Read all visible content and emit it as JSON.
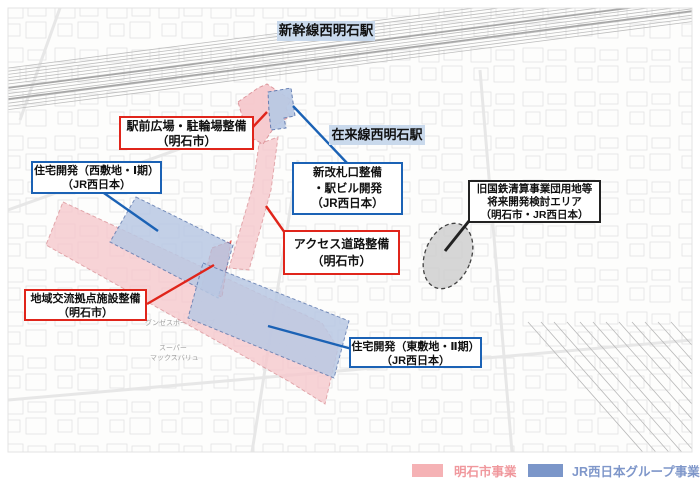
{
  "stations": {
    "shinkansen": "新幹線西明石駅",
    "conventional": "在来線西明石駅"
  },
  "callouts": {
    "ekimae": {
      "lines": [
        "駅前広場・駐輪場整備",
        "（明石市）"
      ],
      "type": "city"
    },
    "jutaku_west": {
      "lines": [
        "住宅開発（西敷地・Ⅰ期）",
        "（JR西日本）"
      ],
      "type": "jr"
    },
    "kaisatsu": {
      "lines": [
        "新改札口整備",
        "・駅ビル開発",
        "（JR西日本）"
      ],
      "type": "jr"
    },
    "access": {
      "lines": [
        "アクセス道路整備",
        "（明石市）"
      ],
      "type": "city"
    },
    "kyoten": {
      "lines": [
        "地域交流拠点施設整備",
        "（明石市）"
      ],
      "type": "city"
    },
    "jutaku_east": {
      "lines": [
        "住宅開発（東敷地・Ⅱ期）",
        "（JR西日本）"
      ],
      "type": "jr"
    },
    "kokutetsu": {
      "lines": [
        "旧国鉄清算事業団用地等",
        "将来開発検討エリア",
        "（明石市・JR西日本）"
      ],
      "type": "future"
    }
  },
  "legend": {
    "city": {
      "label": "明石市事業",
      "color": "#f5b2b5",
      "text_color": "#f0989d"
    },
    "jr": {
      "label": "JR西日本グループ事業",
      "color": "#7b96c9",
      "text_color": "#7f97ca"
    }
  },
  "map_labels": {
    "gunze": "グンゼスポーツクラブ",
    "super": "スーパー",
    "maxvalu": "マックスバリュ"
  },
  "colors": {
    "station_label_bg": "#c9d9ec",
    "city_area": "#f6c9cd",
    "city_area_strong": "#ee8d95",
    "city_area_border": "#dc9298",
    "city_border": "#e0251b",
    "jr_area": "#b9c9e4",
    "jr_area_border": "#5f7ab0",
    "jr_border": "#1b62b5",
    "future_area": "#d0d0d0",
    "future_border": "#222222",
    "map_line": "#bdbdbd"
  }
}
